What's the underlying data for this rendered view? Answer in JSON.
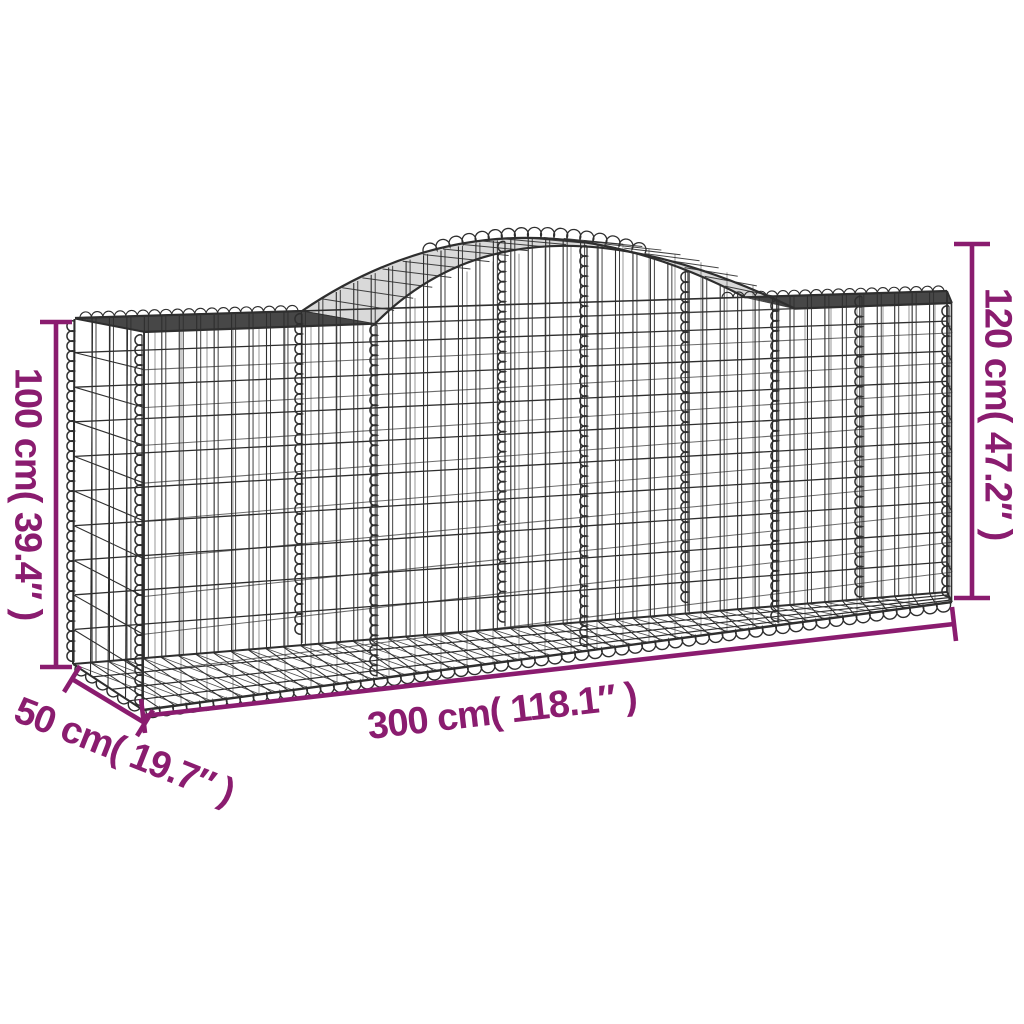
{
  "title": "Arched gabion basket dimension diagram",
  "colors": {
    "accent": "#8A1C6F",
    "wire": "#2e2e2e",
    "background": "#ffffff"
  },
  "labels": {
    "height_left": "100 cm( 39.4″ )",
    "height_right": "120 cm( 47.2″ )",
    "length": "300 cm( 118.1″ )",
    "depth": "50 cm( 19.7″ )"
  }
}
